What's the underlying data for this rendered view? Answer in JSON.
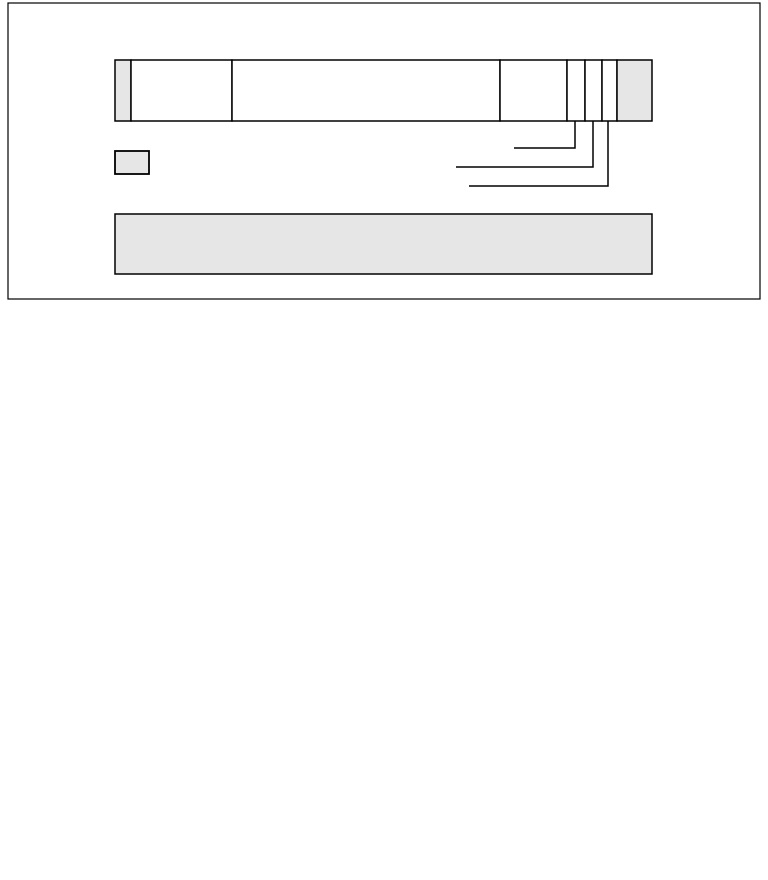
{
  "figure": {
    "description": "empty-frame-format-diagram",
    "colors": {
      "stroke": "#000000",
      "gray_fill": "#e6e6e6",
      "white_fill": "#ffffff",
      "background": "#ffffff"
    },
    "outer_box": {
      "x": 8,
      "y": 3,
      "width": 752,
      "height": 296,
      "stroke_width": 1.2
    },
    "frame_bar": {
      "y": 60,
      "height": 61,
      "stroke_width": 1.5,
      "segments": [
        {
          "name": "flag-left",
          "x": 115,
          "width": 16,
          "fill": "gray"
        },
        {
          "name": "field-1",
          "x": 131,
          "width": 101,
          "fill": "white"
        },
        {
          "name": "field-2",
          "x": 232,
          "width": 268,
          "fill": "white"
        },
        {
          "name": "field-3",
          "x": 500,
          "width": 67,
          "fill": "white"
        },
        {
          "name": "bit-field-1",
          "x": 567,
          "width": 18,
          "fill": "white"
        },
        {
          "name": "bit-field-2",
          "x": 585,
          "width": 17,
          "fill": "white"
        },
        {
          "name": "bit-field-3",
          "x": 602,
          "width": 15,
          "fill": "white"
        },
        {
          "name": "flag-right",
          "x": 617,
          "width": 35,
          "fill": "gray"
        }
      ]
    },
    "callouts": {
      "stroke_width": 1.5,
      "lines": [
        {
          "name": "callout-line-1",
          "from_x": 575,
          "drop_to_y": 148,
          "left_to_x": 514
        },
        {
          "name": "callout-line-2",
          "from_x": 593,
          "drop_to_y": 167,
          "left_to_x": 456
        },
        {
          "name": "callout-line-3",
          "from_x": 608,
          "drop_to_y": 186,
          "left_to_x": 469
        }
      ]
    },
    "legend_box": {
      "x": 115,
      "y": 151,
      "width": 34,
      "height": 23,
      "fill": "gray",
      "stroke_width": 1.8
    },
    "note_box": {
      "x": 115,
      "y": 214,
      "width": 537,
      "height": 60,
      "fill": "gray",
      "stroke_width": 1.5
    }
  }
}
